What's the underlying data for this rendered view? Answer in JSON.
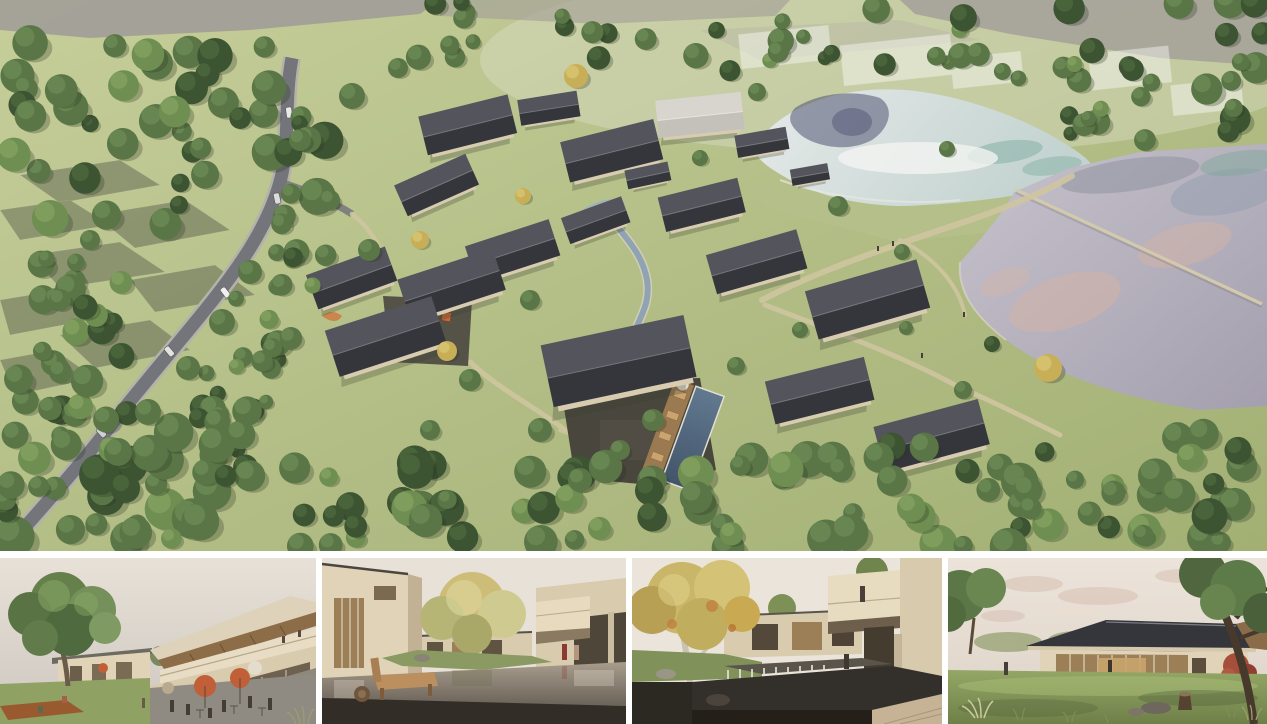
{
  "board": {
    "title": "Resort village masterplan rendering board"
  },
  "hero": {
    "description": "Aerial rendering of a courtyard-house resort village set between a curving rural road with cars on the left and two irrigation ponds on the right, wrapped by dense woodland, with a central stream, cafe plaza with orange umbrellas, playground and a lap pool with timber deck"
  },
  "thumbnails": [
    {
      "id": "plaza-street-view",
      "description": "Eye-level rendering of the village cafe plaza: large green tree at left, two-storey building with tilted timber-soffit roof, storefronts, terracotta market umbrellas and people dining"
    },
    {
      "id": "reflecting-pond-courtyard",
      "description": "Courtyard rendering with a still reflecting pond between cream buildings, a large yellow-green tree, a timber bench on dark paving in the foreground and two people walking at the right"
    },
    {
      "id": "waterfall-courtyard",
      "description": "Courtyard rendering with a weir waterfall pond, golden sycamore tree with pale trunk at left, cantilevered cream balcony volumes at right with a person overlooking"
    },
    {
      "id": "garden-pavilion",
      "description": "Rendering of a single-storey glass pavilion with dark hipped roof on a lawn, red maple shrub, rocks, ornamental grasses and a large dark tree trunk at right under a pale pink evening sky"
    }
  ],
  "palette": {
    "canvas": "#ffffff",
    "meadowHi": "#c6ce9a",
    "meadowLo": "#a2b074",
    "fieldGray": "#a19d98",
    "ghostDark": "#3f453c",
    "forestDark": "#3d5433",
    "forestMid": "#5a7647",
    "forestLight": "#6f8e51",
    "treeYellow": "#c9ae58",
    "roadAsphalt": "#73757a",
    "roadEdge": "#b4b2a9",
    "upperPondHi": "#e6eae9",
    "upperPondLo": "#c3d3d0",
    "pondReflection": "#43476a",
    "pondTeal": "#85b1a4",
    "lakeHi": "#c7c3cc",
    "lakeLo": "#a49fae",
    "lakePeach": "#d6b4a4",
    "lakeBlue": "#95a0b0",
    "causeway": "#b5bf8a",
    "pathTan": "#cfc5a0",
    "roofDark": "#35363c",
    "roofLight": "#54555c",
    "paleRoof": "#d7d5cd",
    "wallBeige": "#d8ccb0",
    "stoneDark": "#433f39",
    "poolHi": "#61798f",
    "poolLo": "#42546a",
    "deckWood": "#a07c52",
    "accentOrange": "#c3693a",
    "playOrange": "#cc7f45",
    "sailWhite": "#efeadd",
    "streamBank": "#d8d2c2",
    "streamWater": "#8fa3b2",
    "panelSkyWarm": "#e7e1d8",
    "panelWall": "#e0d3b7",
    "panelWallDeep": "#d9cbae",
    "panelGlassWarm": "#9c7f57",
    "pondDark": "#33302b",
    "floorDark": "#322d27",
    "benchWood": "#bb905e",
    "terracotta": "#c05f38",
    "sycamoreYellow": "#c9b668",
    "mapleRed": "#a6503c",
    "lawn": "#8fa263",
    "trunkDark": "#473a2d",
    "paleTrunk": "#cac2b2",
    "cortenRust": "#9a5a30"
  }
}
